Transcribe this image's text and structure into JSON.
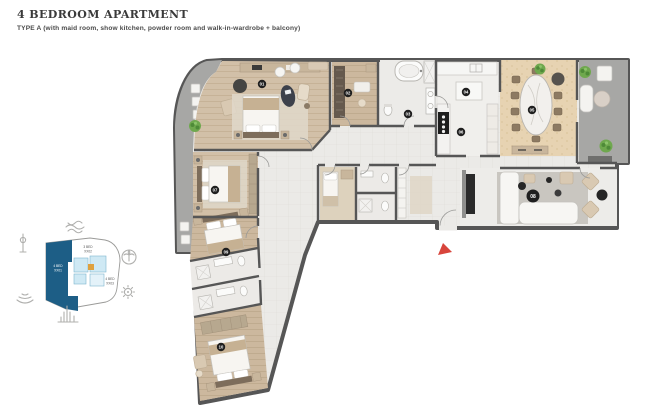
{
  "header": {
    "title": "4 BEDROOM APARTMENT",
    "subtitle": "TYPE A (with maid room, show kitchen, powder room and walk-in-wardrobe + balcony)"
  },
  "keyplan": {
    "units": [
      {
        "name": "4 BED",
        "number": "XX01",
        "highlighted": true
      },
      {
        "name": "3 BED",
        "number": "XX02",
        "highlighted": false
      },
      {
        "name": "4 BED",
        "number": "XX03",
        "highlighted": false
      }
    ],
    "icons": [
      "waves-icon",
      "monument-icon",
      "palm-icon",
      "compass-icon",
      "yacht-icon",
      "skyline-icon"
    ],
    "colors": {
      "highlight": "#1d5e86",
      "adjacent_units": "#cfe9f4",
      "core_accent": "#dfa13e"
    }
  },
  "floorplan": {
    "badges": [
      {
        "label": "01",
        "room": "master-bedroom"
      },
      {
        "label": "02",
        "room": "walk-in-wardrobe"
      },
      {
        "label": "03",
        "room": "master-bathroom"
      },
      {
        "label": "04",
        "room": "show-kitchen"
      },
      {
        "label": "05",
        "room": "dining"
      },
      {
        "label": "06",
        "room": "kitchen"
      },
      {
        "label": "07",
        "room": "bedroom-2"
      },
      {
        "label": "08",
        "room": "living"
      },
      {
        "label": "09",
        "room": "bedroom-3"
      },
      {
        "label": "10",
        "room": "bedroom-4"
      }
    ],
    "entrance_marker": "main-entrance",
    "colors": {
      "wall": "#565656",
      "wood_floor": "#d2c0a8",
      "tile_floor": "#ebeae7",
      "dining_floor": "#e7d3b2",
      "balcony_floor": "#a7a7a5",
      "plant_green": "#6fa84e",
      "entrance_red": "#d8453c"
    }
  }
}
